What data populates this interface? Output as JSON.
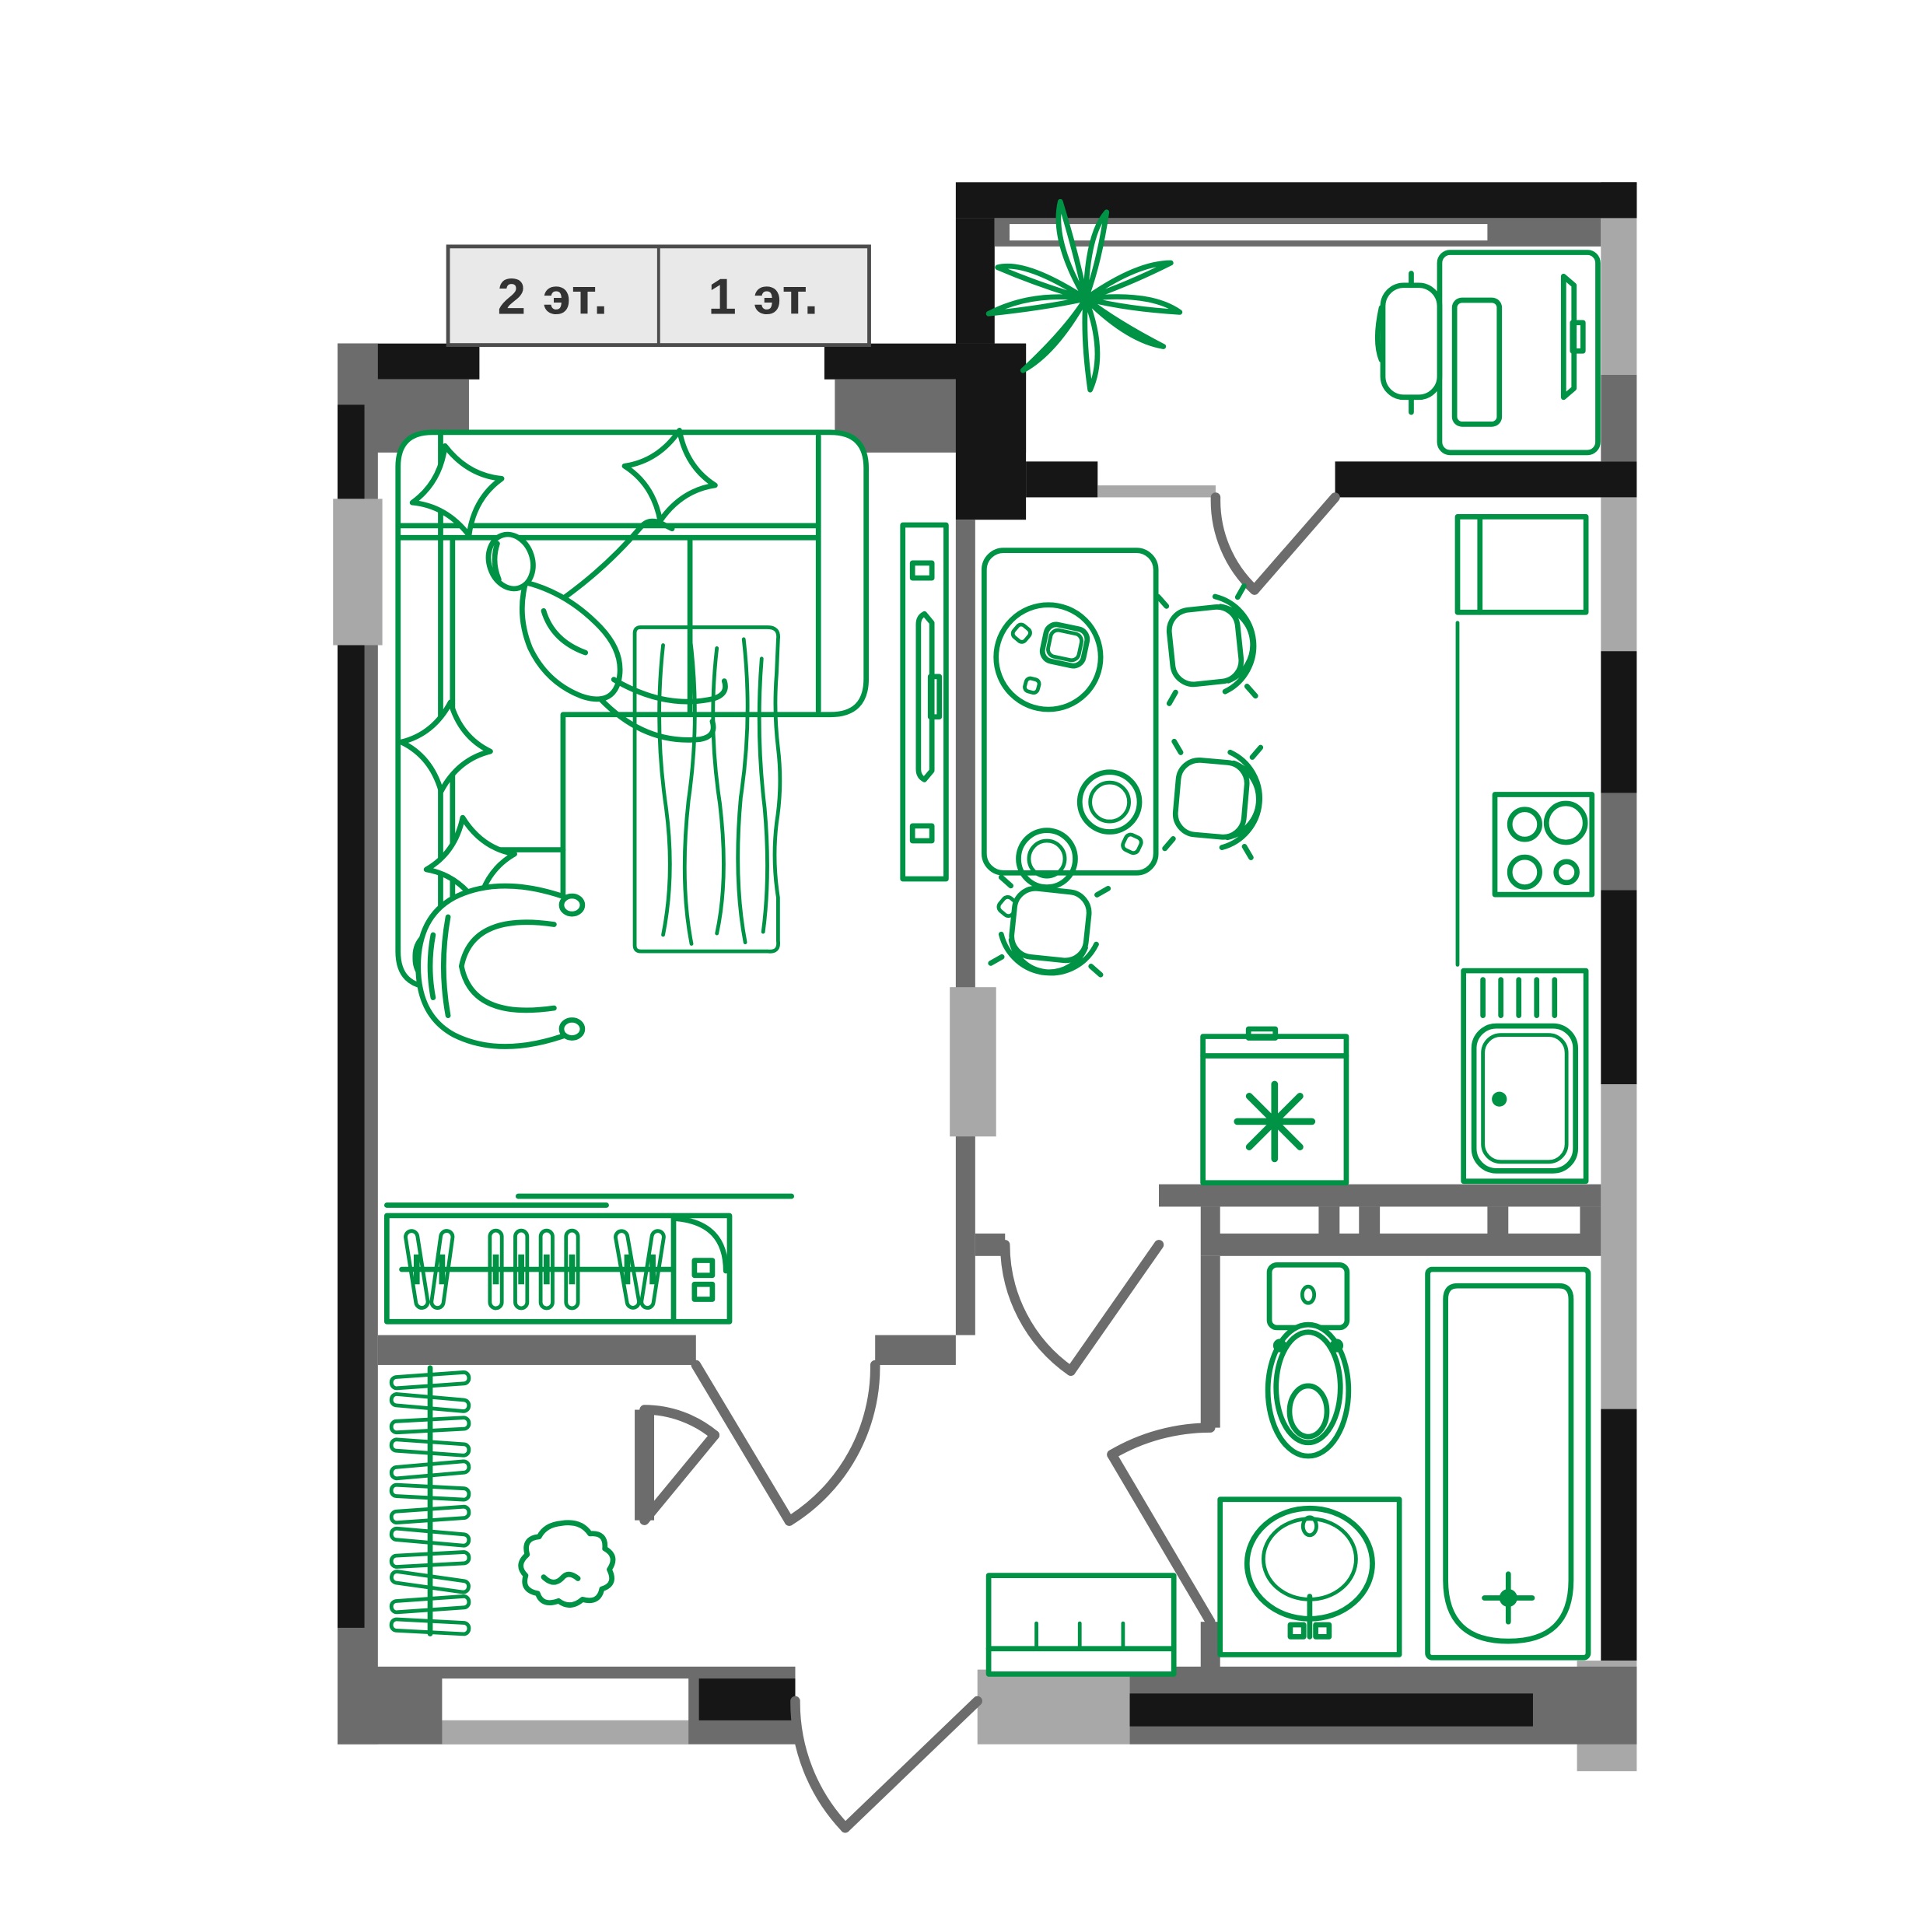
{
  "floor_selector": {
    "options": [
      {
        "label": "2 эт."
      },
      {
        "label": "1 эт."
      }
    ]
  },
  "colors": {
    "furniture_green": "#009245",
    "wall_black": "#161616",
    "wall_dark_gray": "#6c6c6c",
    "wall_light_gray": "#a8a8a8",
    "label_bg": "#e9e9e9",
    "label_border": "#4c4c4c",
    "label_text": "#333333",
    "background": "#ffffff"
  },
  "furniture_items": [
    "corner-sofa",
    "pillows",
    "person-lying",
    "rug",
    "armchair",
    "tv-unit",
    "wardrobe-hangers",
    "closet-rack",
    "pouf",
    "dining-table",
    "plates",
    "chairs",
    "washing-machine",
    "kitchen-sink",
    "stove",
    "fridge",
    "counter",
    "toilet",
    "bathtub",
    "bath-sink",
    "shoe-bench",
    "balcony-plant",
    "balcony-desk",
    "office-chair",
    "monitor"
  ]
}
